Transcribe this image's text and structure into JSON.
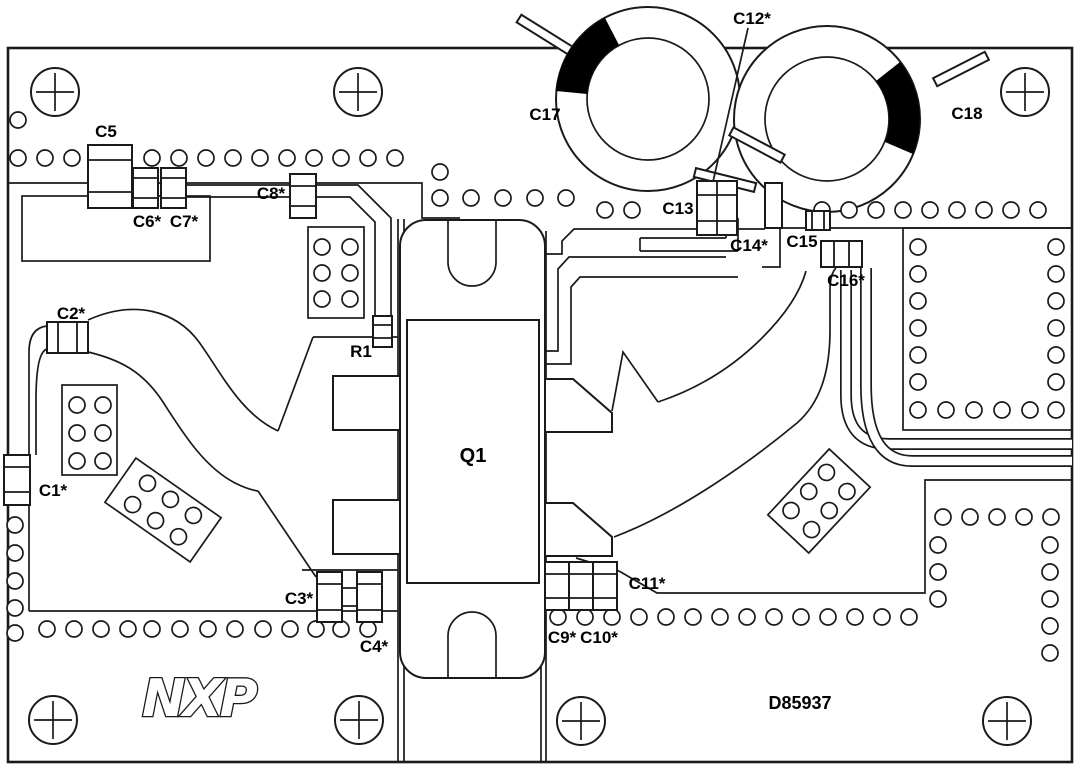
{
  "board": {
    "logo": "NXP",
    "number": "D85937"
  },
  "labels": {
    "c1": "C1*",
    "c2": "C2*",
    "c3": "C3*",
    "c4": "C4*",
    "c5": "C5",
    "c6": "C6*",
    "c7": "C7*",
    "c8": "C8*",
    "c9": "C9*",
    "c10": "C10*",
    "c11": "C11*",
    "c12": "C12*",
    "c13": "C13",
    "c14": "C14*",
    "c15": "C15",
    "c16": "C16*",
    "c17": "C17",
    "c18": "C18",
    "q1": "Q1",
    "r1": "R1"
  },
  "colors": {
    "line": "#1a1a1a",
    "background": "#ffffff",
    "toroid_mark": "#000000"
  }
}
